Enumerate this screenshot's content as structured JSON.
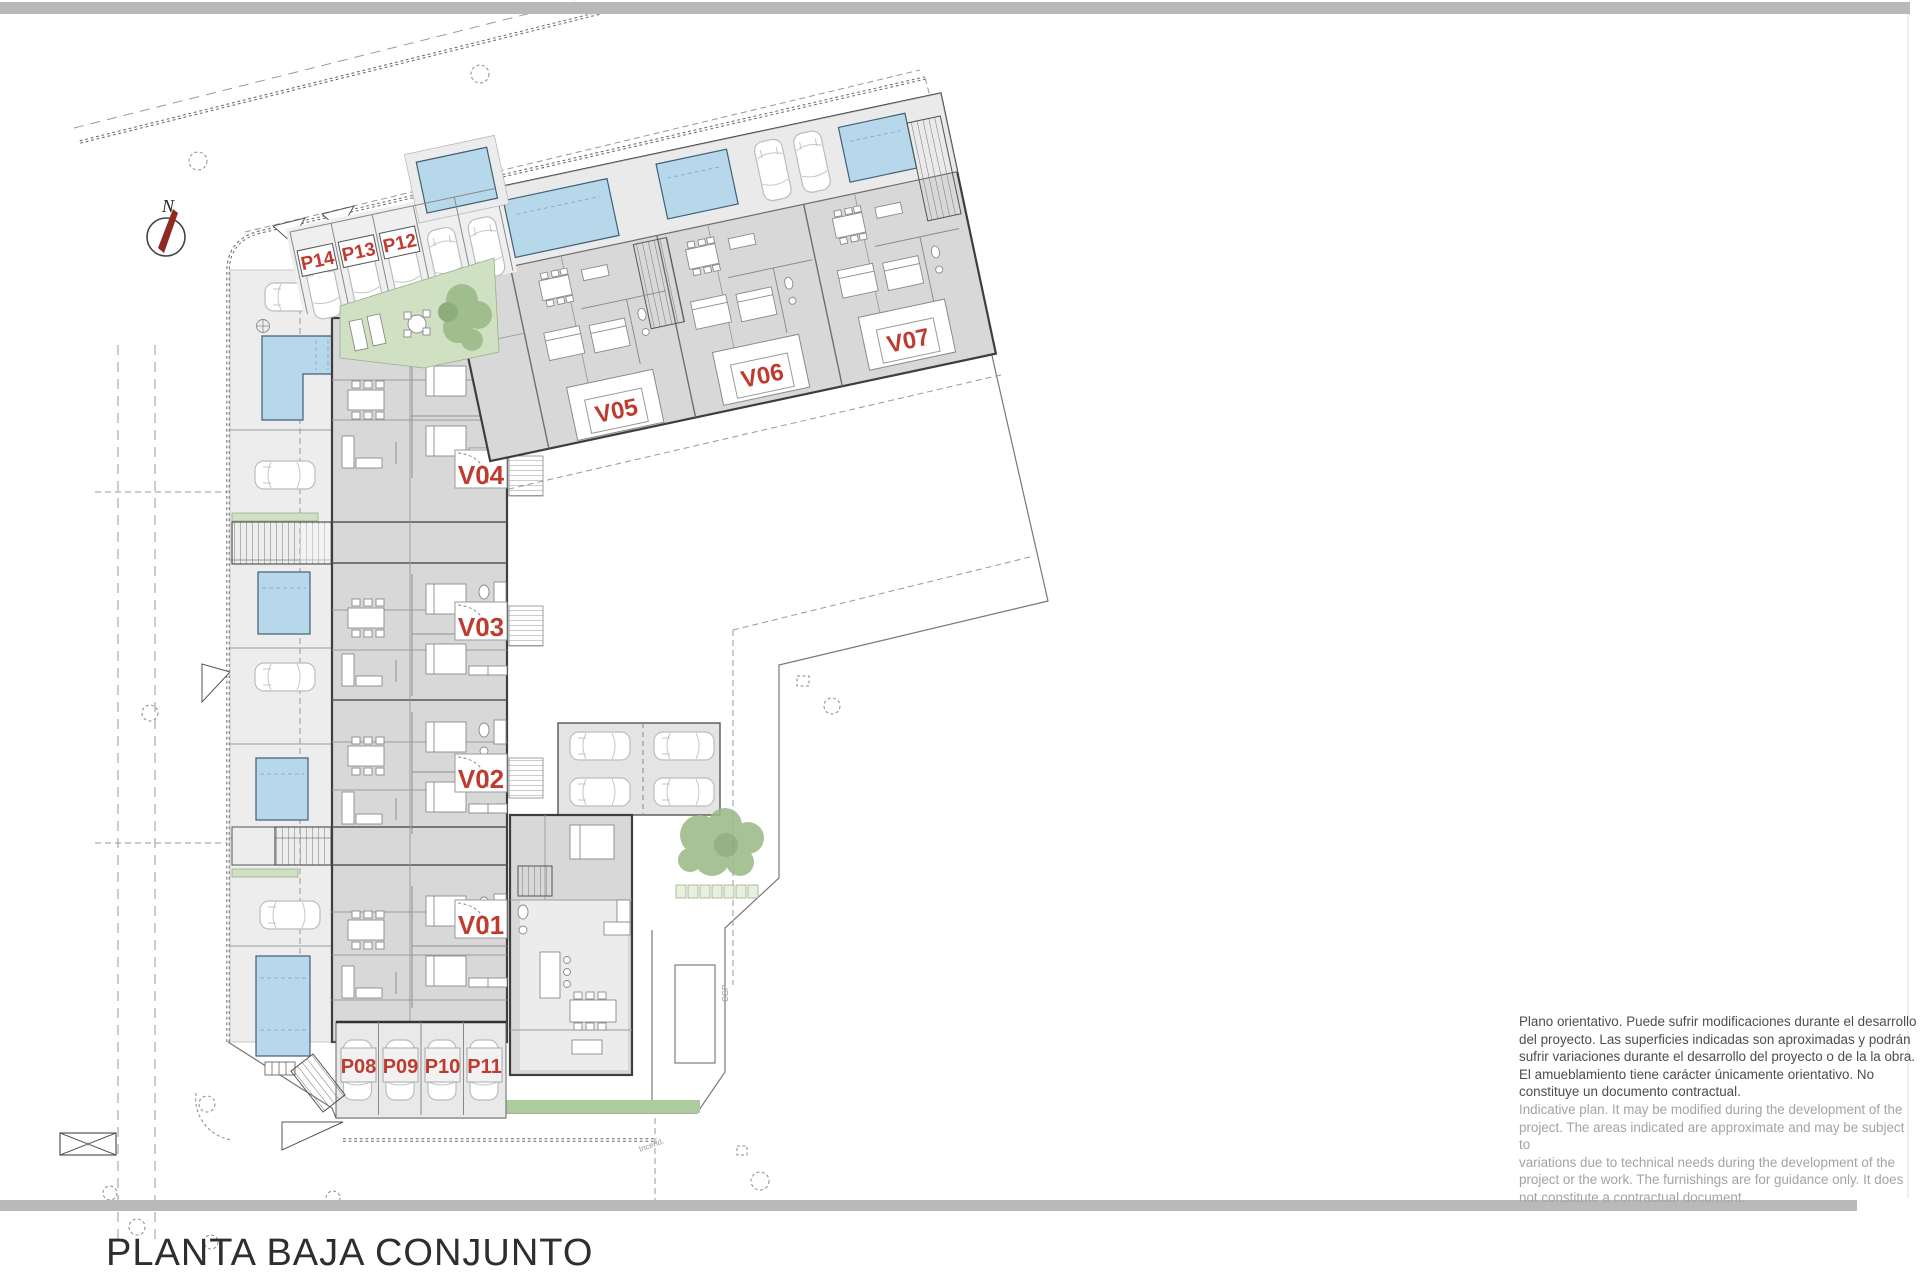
{
  "sheet": {
    "title": "PLANTA BAJA CONJUNTO"
  },
  "compass": {
    "north": "N"
  },
  "labels": {
    "villas": [
      "V01",
      "V02",
      "V03",
      "V04",
      "V05",
      "V06",
      "V07"
    ],
    "parking_top": [
      "P14",
      "P13",
      "P12"
    ],
    "parking_bottom": [
      "P08",
      "P09",
      "P10",
      "P11"
    ]
  },
  "annotations": {
    "cgp": "CGP",
    "incend": "Incend."
  },
  "disclaimer": {
    "es": [
      "Plano orientativo. Puede sufrir modificaciones durante el desarrollo",
      "del proyecto. Las superficies indicadas son aproximadas y podrán",
      "sufrir variaciones durante el desarrollo del proyecto o de la la obra.",
      "El amueblamiento tiene carácter únicamente orientativo. No",
      "constituye un documento contractual."
    ],
    "en": [
      "Indicative plan. It may be modified during the development of the",
      "project. The areas indicated are approximate and may be subject to",
      "variations due to technical needs during the development of the",
      "project or the work. The furnishings are for guidance only. It does",
      "not constitute a contractual document."
    ]
  },
  "colors": {
    "accent_red": "#bf3b30",
    "pool_blue": "#b7d7eb",
    "garden_green": "#cfe0c3",
    "building_gray": "#d8d8d8",
    "bar_gray": "#b9b9b9"
  }
}
